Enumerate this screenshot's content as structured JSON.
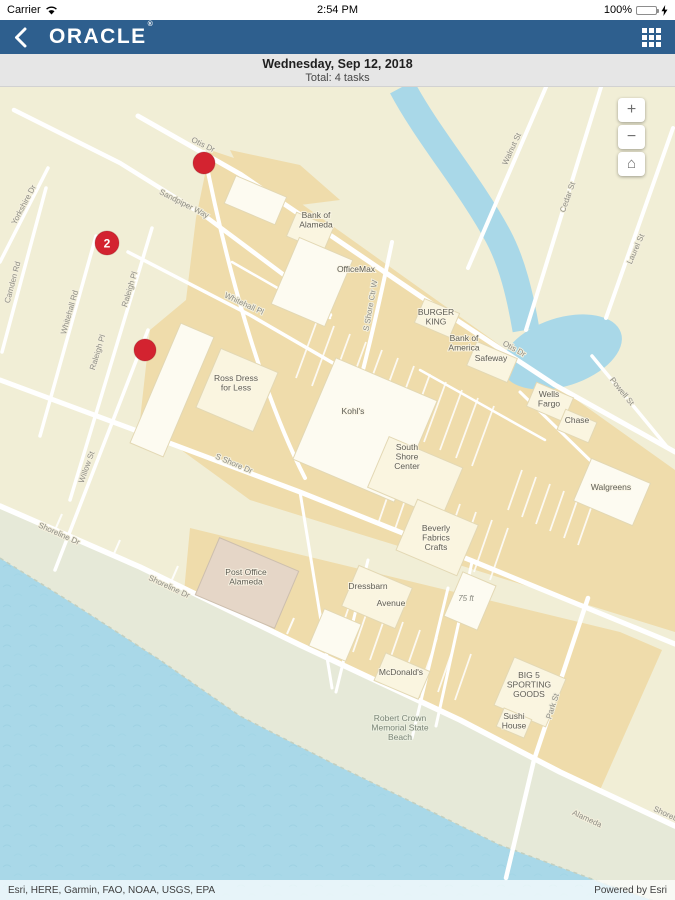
{
  "status_bar": {
    "carrier": "Carrier",
    "time": "2:54 PM",
    "battery_pct": "100%"
  },
  "nav_bar": {
    "logo": "ORACLE",
    "logo_mark": "®"
  },
  "date_header": {
    "date": "Wednesday, Sep 12, 2018",
    "total": "Total: 4 tasks"
  },
  "map": {
    "controls": {
      "zoom_in": "+",
      "zoom_out": "−",
      "home": "⌂"
    },
    "colors": {
      "nav_blue": "#2e5f8e",
      "marker_red": "#d32330",
      "water": "#a9d8e8",
      "land": "#f1eed6",
      "commercial": "#efdcab",
      "building": "#faf5e0",
      "beach": "#e6e9d8"
    },
    "markers": [
      {
        "x": 204,
        "y": 163,
        "count": ""
      },
      {
        "x": 107,
        "y": 243,
        "count": "2"
      },
      {
        "x": 145,
        "y": 350,
        "count": ""
      }
    ],
    "street_labels": [
      {
        "text": "Otis Dr",
        "x": 202,
        "y": 147,
        "r": 26
      },
      {
        "text": "Otis Dr",
        "x": 513,
        "y": 351,
        "r": 29
      },
      {
        "text": "Sandpiper Way",
        "x": 183,
        "y": 206,
        "r": 27
      },
      {
        "text": "Whitehall Pl",
        "x": 243,
        "y": 306,
        "r": 25
      },
      {
        "text": "Yorkshire Dr",
        "x": 26,
        "y": 206,
        "r": -62
      },
      {
        "text": "Camden Rd",
        "x": 15,
        "y": 283,
        "r": -75
      },
      {
        "text": "Whitehall Rd",
        "x": 72,
        "y": 313,
        "r": -74
      },
      {
        "text": "Raleigh Pl",
        "x": 132,
        "y": 290,
        "r": -73
      },
      {
        "text": "Raleigh Pl",
        "x": 100,
        "y": 353,
        "r": -73
      },
      {
        "text": "Willow St",
        "x": 89,
        "y": 468,
        "r": -70
      },
      {
        "text": "S Shore Ctr W",
        "x": 373,
        "y": 306,
        "r": -80
      },
      {
        "text": "S Shore Dr",
        "x": 233,
        "y": 466,
        "r": 23
      },
      {
        "text": "Shoreline Dr",
        "x": 58,
        "y": 536,
        "r": 24
      },
      {
        "text": "Shoreline Dr",
        "x": 168,
        "y": 589,
        "r": 25
      },
      {
        "text": "Walnut St",
        "x": 514,
        "y": 150,
        "r": -65
      },
      {
        "text": "Cedar St",
        "x": 570,
        "y": 198,
        "r": -70
      },
      {
        "text": "Laurel St",
        "x": 638,
        "y": 250,
        "r": -66
      },
      {
        "text": "Powell St",
        "x": 620,
        "y": 393,
        "r": 51
      },
      {
        "text": "Park St",
        "x": 555,
        "y": 707,
        "r": -72
      },
      {
        "text": "Alameda",
        "x": 586,
        "y": 821,
        "r": 25
      },
      {
        "text": "Shoreline Dr",
        "x": 673,
        "y": 820,
        "r": 25
      }
    ],
    "poi_labels": [
      {
        "lines": [
          "Bank of",
          "Alameda"
        ],
        "x": 316,
        "y": 218,
        "style": "poi"
      },
      {
        "lines": [
          "OfficeMax"
        ],
        "x": 356,
        "y": 272,
        "style": "poi"
      },
      {
        "lines": [
          "BURGER",
          "KING"
        ],
        "x": 436,
        "y": 315,
        "style": "poi"
      },
      {
        "lines": [
          "Bank of",
          "America"
        ],
        "x": 464,
        "y": 341,
        "style": "poi"
      },
      {
        "lines": [
          "Safeway"
        ],
        "x": 491,
        "y": 361,
        "style": "poi"
      },
      {
        "lines": [
          "Wells",
          "Fargo"
        ],
        "x": 549,
        "y": 397,
        "style": "poi"
      },
      {
        "lines": [
          "Chase"
        ],
        "x": 577,
        "y": 423,
        "style": "poi"
      },
      {
        "lines": [
          "Walgreens"
        ],
        "x": 611,
        "y": 490,
        "style": "poi"
      },
      {
        "lines": [
          "Ross Dress",
          "for Less"
        ],
        "x": 236,
        "y": 381,
        "style": "poi"
      },
      {
        "lines": [
          "Kohl's"
        ],
        "x": 353,
        "y": 414,
        "style": "poi"
      },
      {
        "lines": [
          "South",
          "Shore",
          "Center"
        ],
        "x": 407,
        "y": 450,
        "style": "poi"
      },
      {
        "lines": [
          "Beverly",
          "Fabrics",
          "Crafts"
        ],
        "x": 436,
        "y": 531,
        "style": "poi"
      },
      {
        "lines": [
          "Post Office",
          "Alameda"
        ],
        "x": 246,
        "y": 575,
        "style": "poi"
      },
      {
        "lines": [
          "Dressbarn"
        ],
        "x": 368,
        "y": 589,
        "style": "poi"
      },
      {
        "lines": [
          "Avenue"
        ],
        "x": 391,
        "y": 606,
        "style": "poi"
      },
      {
        "lines": [
          "McDonald's"
        ],
        "x": 401,
        "y": 675,
        "style": "poi"
      },
      {
        "lines": [
          "BIG 5",
          "SPORTING",
          "GOODS"
        ],
        "x": 529,
        "y": 678,
        "style": "poi"
      },
      {
        "lines": [
          "Sushi",
          "House"
        ],
        "x": 514,
        "y": 719,
        "style": "poi"
      },
      {
        "lines": [
          "Robert Crown",
          "Memorial State",
          "Beach"
        ],
        "x": 400,
        "y": 721,
        "style": "area"
      },
      {
        "lines": [
          "75 ft"
        ],
        "x": 466,
        "y": 601,
        "style": "scale"
      }
    ],
    "attribution": {
      "sources": "Esri, HERE, Garmin, FAO, NOAA, USGS, EPA",
      "powered": "Powered by Esri"
    }
  }
}
